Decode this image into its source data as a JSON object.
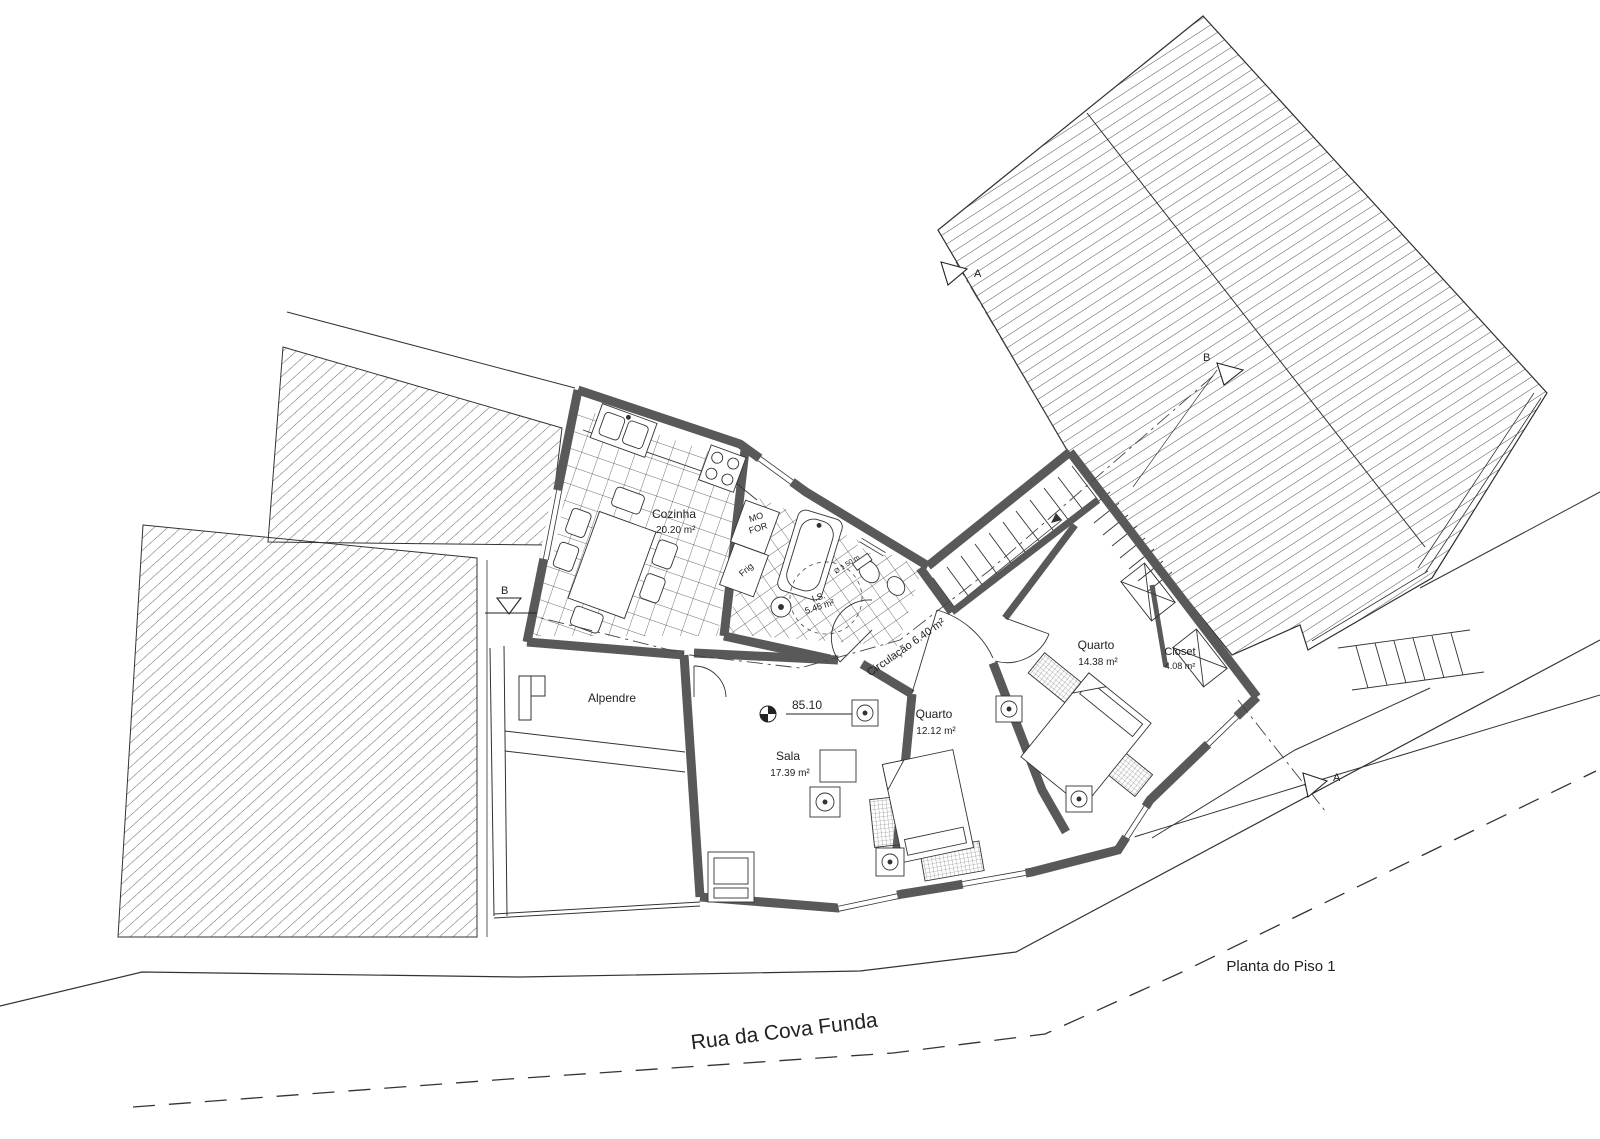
{
  "drawing": {
    "title": "Planta do Piso 1",
    "street": "Rua da Cova Funda",
    "level_marker": "85.10",
    "rooms": {
      "cozinha": {
        "name": "Cozinha",
        "area": "20.20 m²"
      },
      "is": {
        "name": "I.S.",
        "area": "5.45 m²"
      },
      "circulacao": {
        "label": "Circulação 6.40 m²"
      },
      "alpendre": {
        "name": "Alpendre"
      },
      "sala": {
        "name": "Sala",
        "area": "17.39 m²"
      },
      "quarto_1": {
        "name": "Quarto",
        "area": "12.12 m²"
      },
      "quarto_2": {
        "name": "Quarto",
        "area": "14.38 m²"
      },
      "closet": {
        "name": "Closet",
        "area": "4.08 m²"
      }
    },
    "kitchen_appliances": {
      "micro_oven_line1": "MO",
      "micro_oven_line2": "FOR",
      "fridge": "Frig"
    },
    "bath": {
      "turning_circle": "Ø 1.50 m"
    },
    "section_markers": {
      "a": "A",
      "b": "B"
    },
    "colors": {
      "wall": "#595959",
      "line": "#2b2b2b",
      "street_text": "#b6b6b6"
    }
  }
}
